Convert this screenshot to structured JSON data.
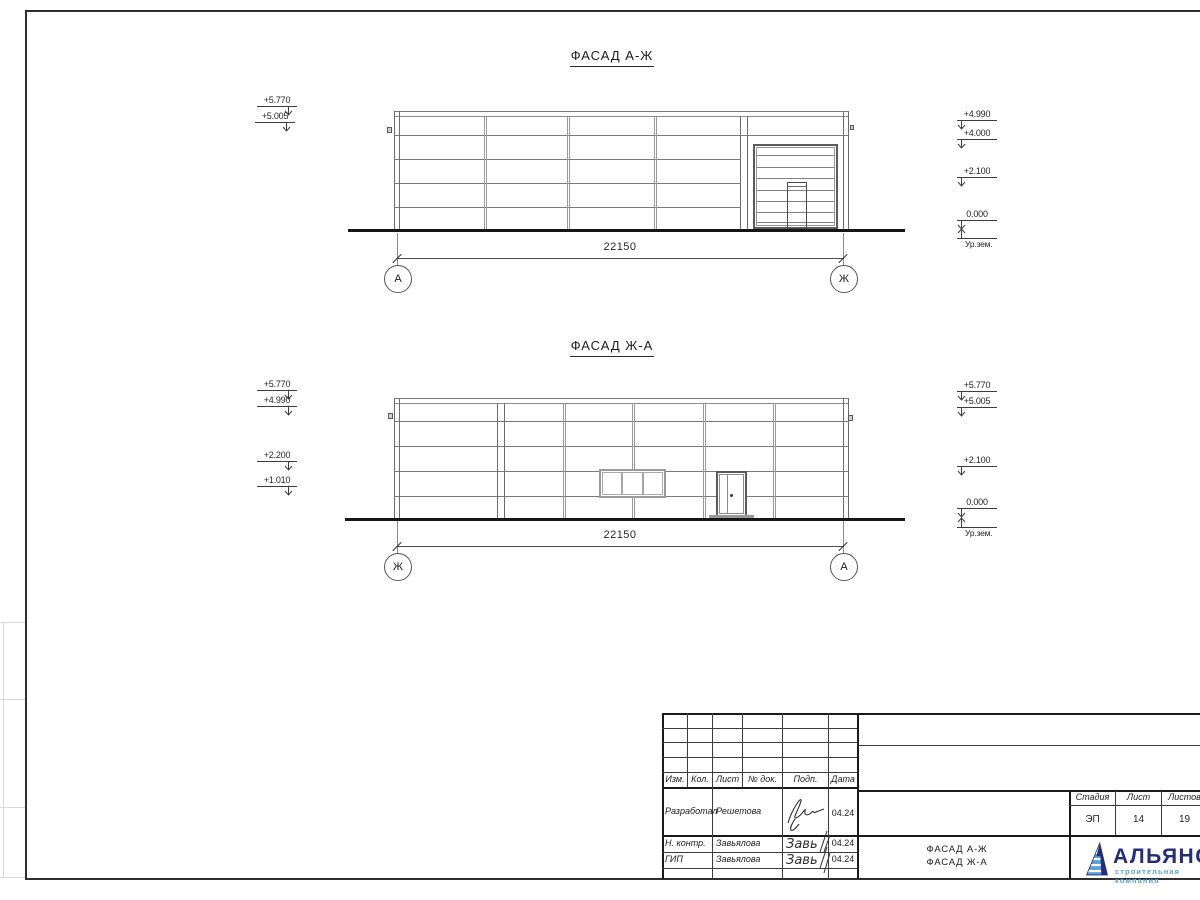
{
  "facade_top": {
    "title": "ФАСАД А-Ж",
    "dimension": "22150",
    "axis_left": "А",
    "axis_right": "Ж",
    "marks_left": [
      {
        "value": "+5.770"
      },
      {
        "value": "+5.005"
      }
    ],
    "marks_right": [
      {
        "value": "+4.990"
      },
      {
        "value": "+4.000"
      },
      {
        "value": "+2.100"
      },
      {
        "value": "0.000"
      },
      {
        "value": "Ур.зем."
      }
    ]
  },
  "facade_bottom": {
    "title": "ФАСАД Ж-А",
    "dimension": "22150",
    "axis_left": "Ж",
    "axis_right": "А",
    "marks_left": [
      {
        "value": "+5.770"
      },
      {
        "value": "+4.990"
      },
      {
        "value": "+2.200"
      },
      {
        "value": "+1.010"
      }
    ],
    "marks_right": [
      {
        "value": "+5.770"
      },
      {
        "value": "+5.005"
      },
      {
        "value": "+2.100"
      },
      {
        "value": "0.000"
      },
      {
        "value": "Ур.зем."
      }
    ]
  },
  "title_block": {
    "revision_headers": [
      "Изм.",
      "Кол.",
      "Лист",
      "№ док.",
      "Подп.",
      "Дата"
    ],
    "signature_rows": [
      {
        "role": "Разработал",
        "name": "Решетова",
        "date": "04.24"
      },
      {
        "role": "Н. контр.",
        "name": "Завьялова",
        "date": "04.24"
      },
      {
        "role": "ГИП",
        "name": "Завьялова",
        "date": "04.24"
      }
    ],
    "sheet_name_line1": "ФАСАД А-Ж",
    "sheet_name_line2": "ФАСАД Ж-А",
    "stage_headers": [
      "Стадия",
      "Лист",
      "Листов"
    ],
    "stage_values": [
      "ЭП",
      "14",
      "19"
    ],
    "logo": {
      "name": "АЛЬЯНС",
      "tagline": "строительная компания",
      "primary_color": "#232d7b",
      "secondary_color": "#5e9fcf"
    }
  }
}
